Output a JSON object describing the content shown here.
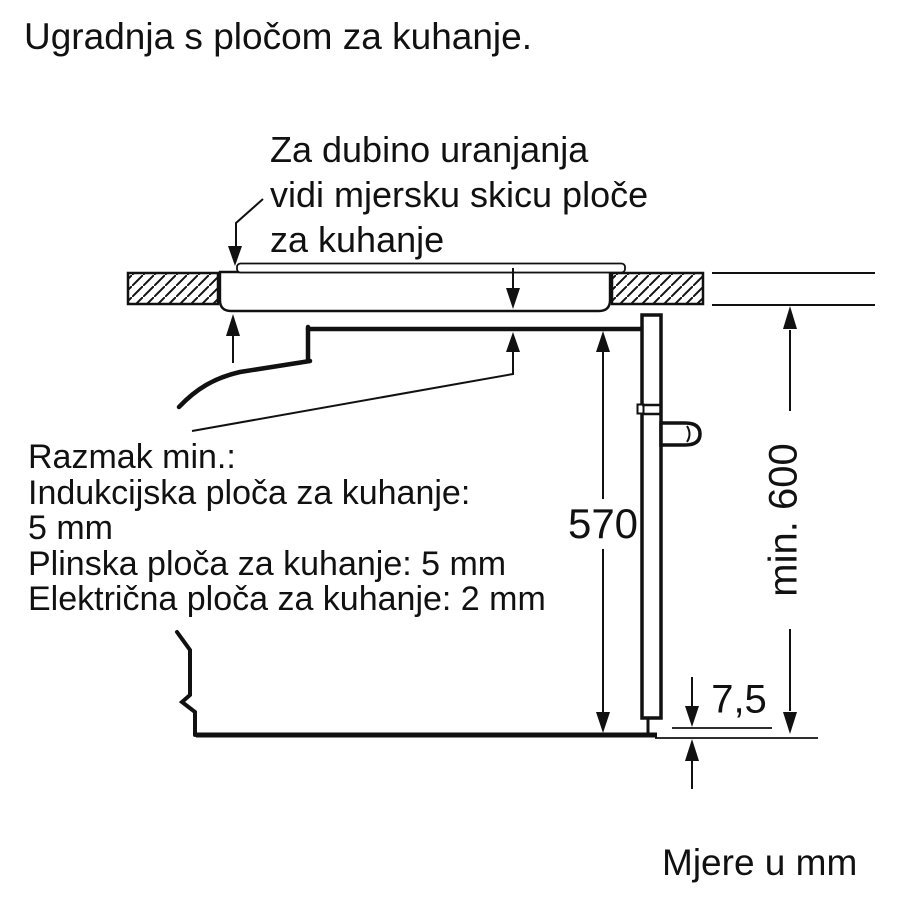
{
  "page": {
    "title": "Ugradnja s pločom za kuhanje.",
    "footer": "Mjere u mm"
  },
  "annotation": {
    "lines": [
      "Za dubino uranjanja",
      "vidi mjersku skicu ploče",
      "za kuhanje"
    ]
  },
  "clearance": {
    "lines": [
      "Razmak min.:",
      "Indukcijska ploča za kuhanje:",
      "5 mm",
      "Plinska ploča za kuhanje: 5 mm",
      "Električna ploča za kuhanje: 2 mm"
    ]
  },
  "dimensions": {
    "oven_height_mm": "570",
    "niche_height_min": "min. 600",
    "bottom_clearance_mm": "7,5"
  },
  "style": {
    "line_color": "#111111",
    "background": "#ffffff"
  }
}
